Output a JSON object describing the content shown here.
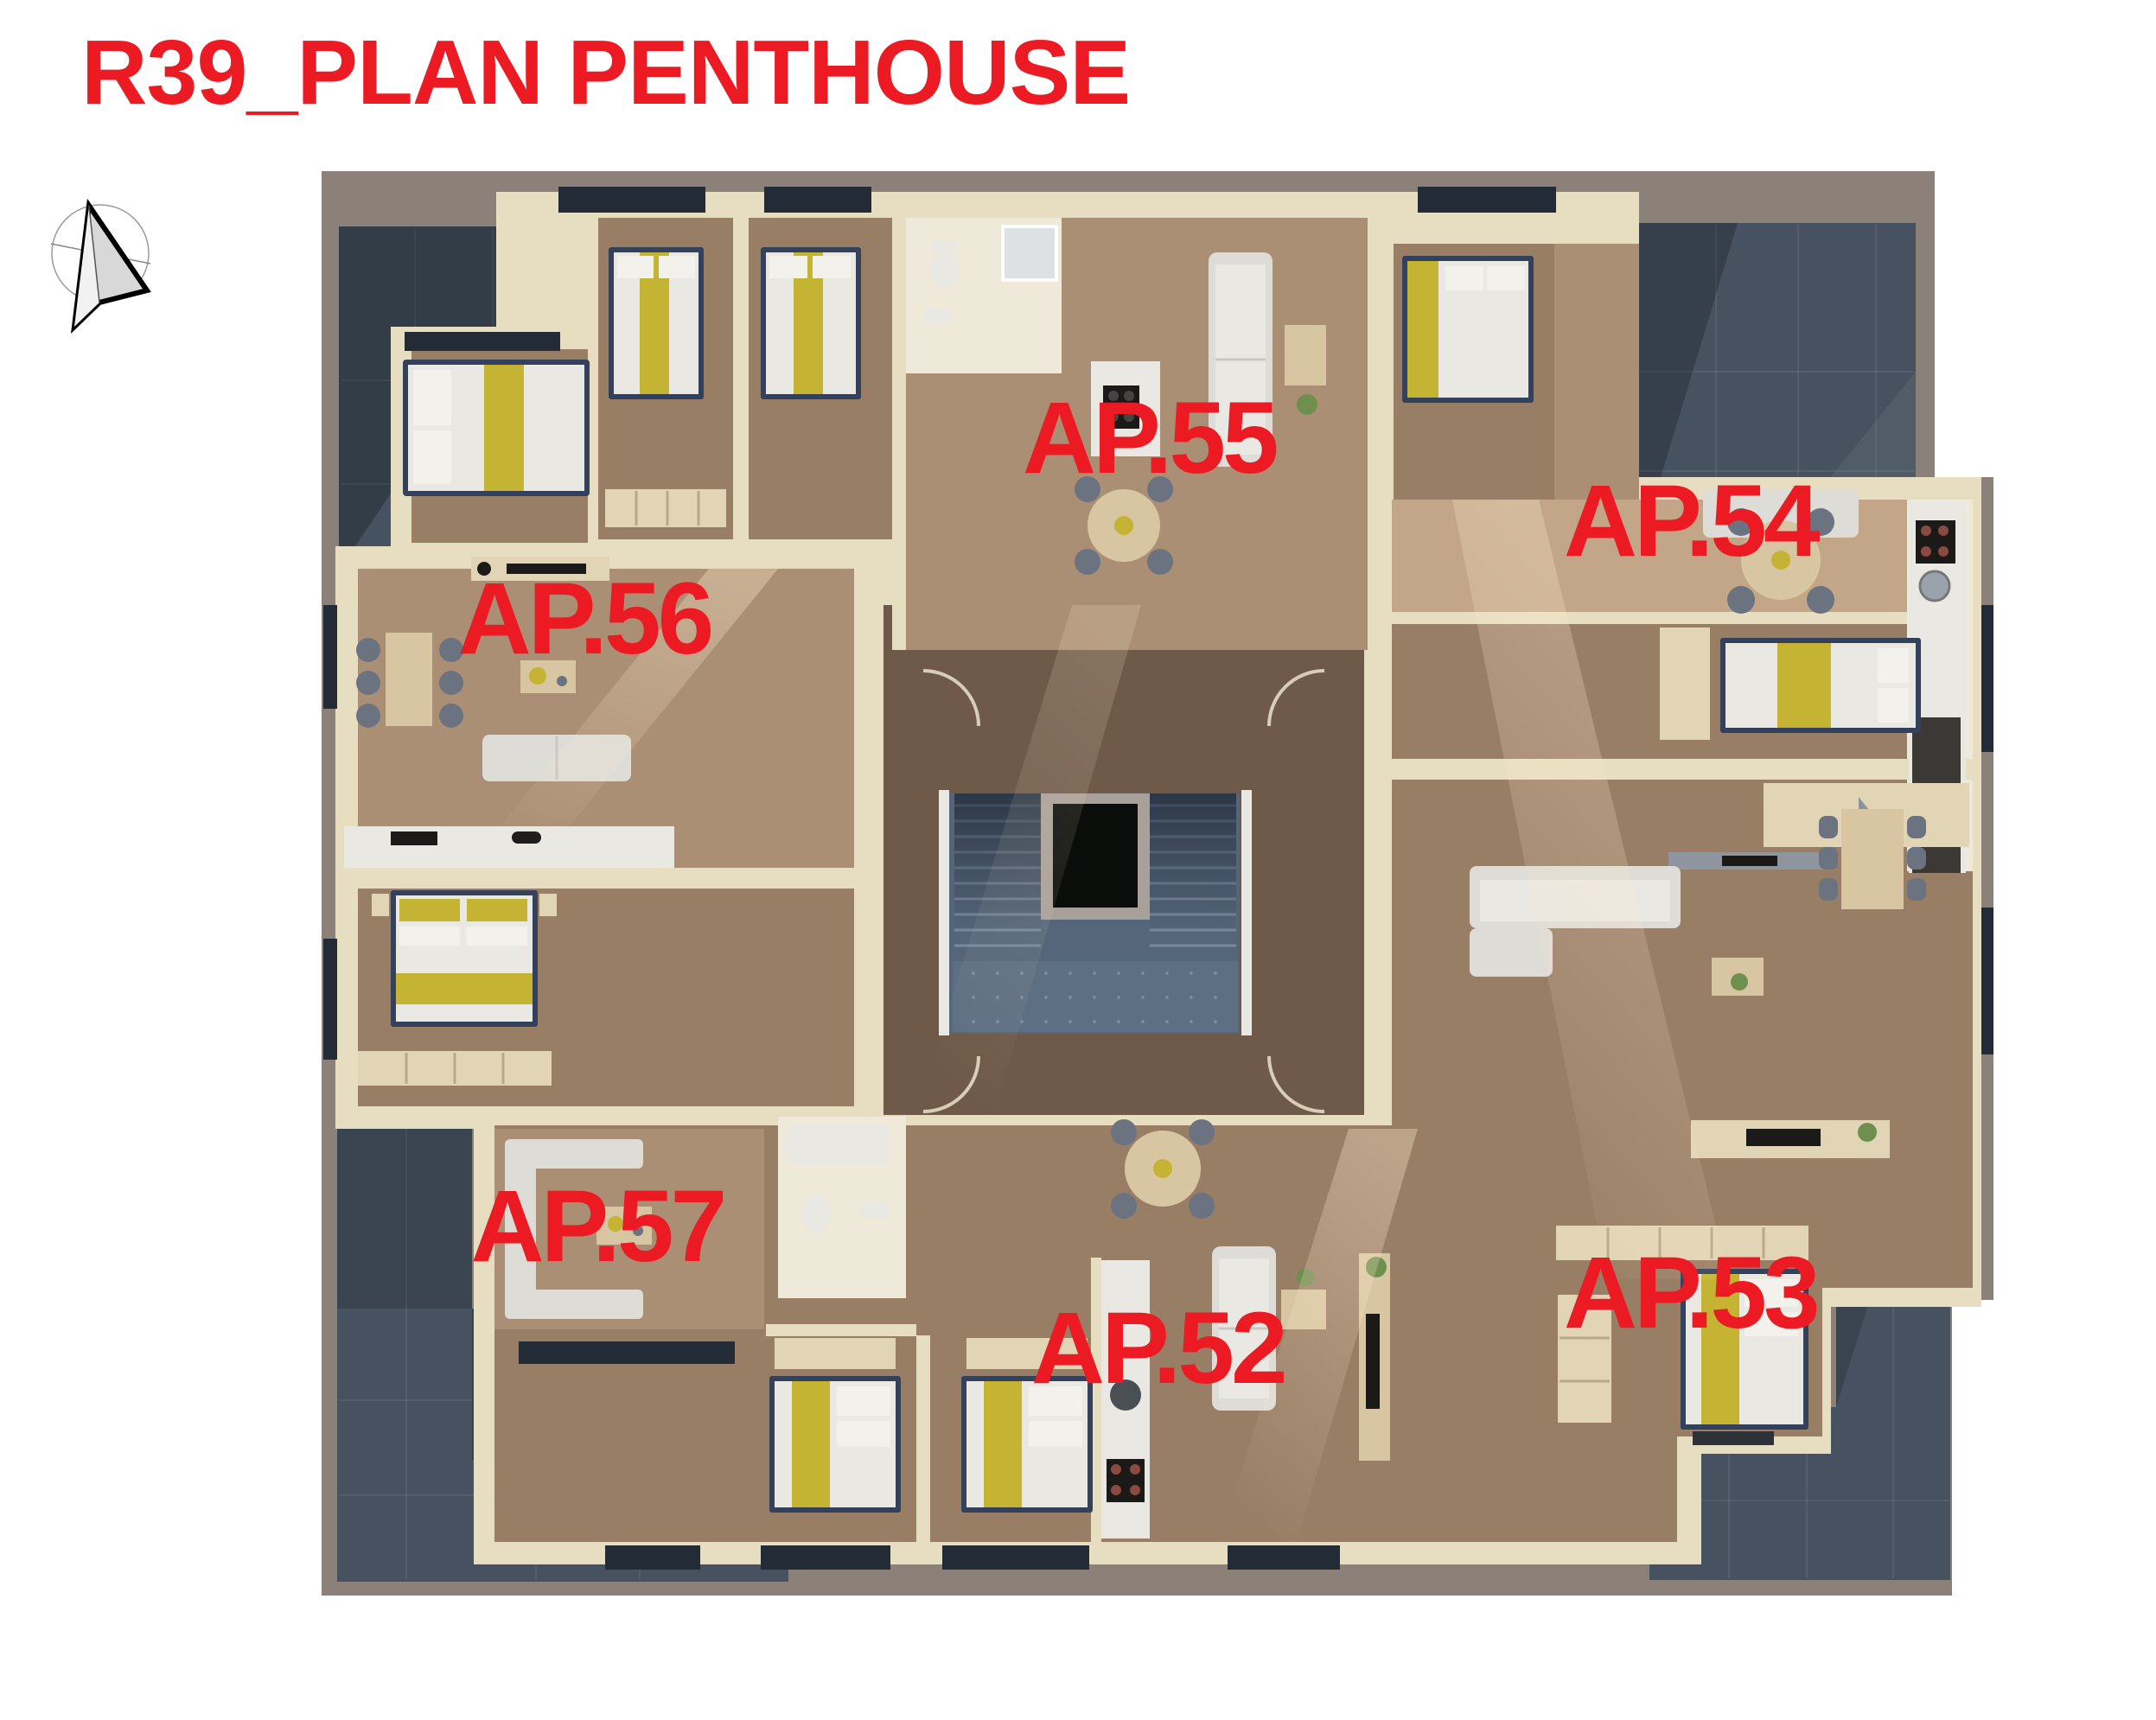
{
  "title": {
    "text": "R39_PLAN PENTHOUSE"
  },
  "compass": {
    "icon": "north-arrow-icon",
    "description": "north arrow in circle"
  },
  "floor_plan": {
    "kind": "3d-rendered-penthouse-floor-plan",
    "apartments": [
      {
        "id": "ap56",
        "label": "AP.56",
        "x_pct": 27.1,
        "y_pct": 36.0
      },
      {
        "id": "ap55",
        "label": "AP.55",
        "x_pct": 53.3,
        "y_pct": 25.5
      },
      {
        "id": "ap54",
        "label": "AP.54",
        "x_pct": 78.4,
        "y_pct": 30.3
      },
      {
        "id": "ap57",
        "label": "AP.57",
        "x_pct": 27.7,
        "y_pct": 71.3
      },
      {
        "id": "ap52",
        "label": "AP.52",
        "x_pct": 53.7,
        "y_pct": 78.4
      },
      {
        "id": "ap53",
        "label": "AP.53",
        "x_pct": 78.4,
        "y_pct": 75.2
      }
    ]
  },
  "palette": {
    "accent_red": "#EC1B23",
    "parapet_taupe": "#8C8178",
    "terrace_slate": "#46525F",
    "balcony_brown": "#4A443C",
    "wall_cream": "#E7DDC1",
    "wall_light": "#EFE9DA",
    "floor_light": "#AB8F74",
    "floor_mid": "#997E66",
    "floor_sun": "#C2A687",
    "corridor_wood": "#6F5A4A",
    "stair_concrete": "#55667A",
    "landing_concrete": "#5D6F83",
    "elevator_black": "#0A0D0A",
    "furniture_white": "#EAE8E2",
    "sofa_gray": "#DEDCD6",
    "cabinet_beige": "#E2D5B5",
    "table_wood": "#D8C6A3",
    "bed_yellow": "#C5B334",
    "bed_navy": "#33415C",
    "appliance_dark": "#1C1A18",
    "chair_gray": "#6B7280",
    "window_dark": "#232B36",
    "plant_green": "#6F8F4F"
  }
}
